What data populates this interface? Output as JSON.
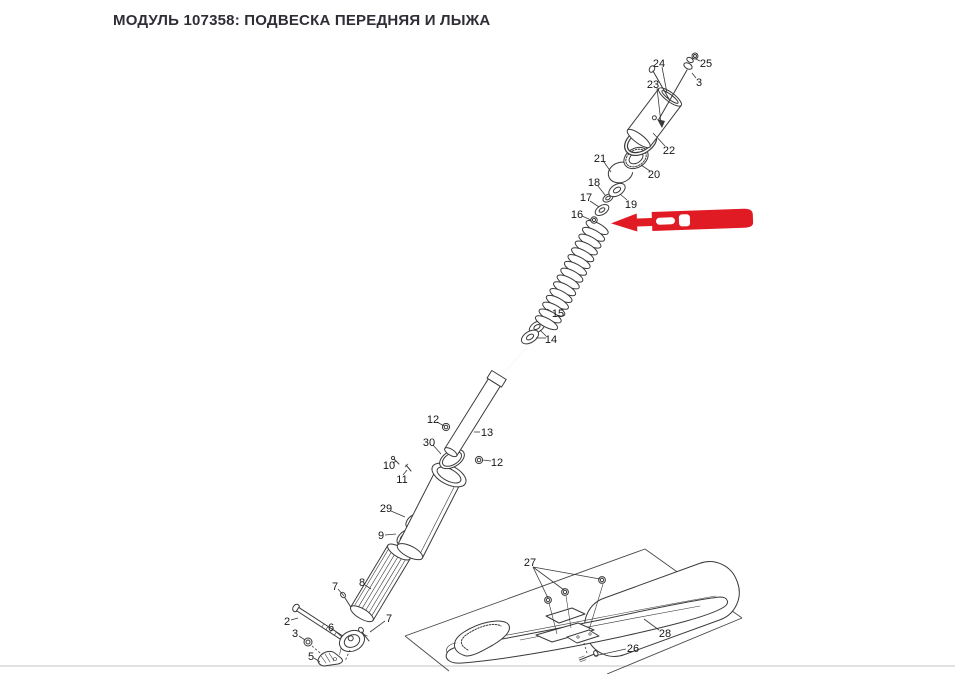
{
  "page": {
    "title": "МОДУЛЬ 107358: ПОДВЕСКА ПЕРЕДНЯЯ И ЛЫЖА"
  },
  "colors": {
    "arrow_red": "#e01b24",
    "line": "#3a3a3a",
    "title_text": "#2e2e36",
    "frame_line": "#cfcfcf"
  },
  "callouts": [
    {
      "label": "24"
    },
    {
      "label": "25"
    },
    {
      "label": "23"
    },
    {
      "label": "3"
    },
    {
      "label": "22"
    },
    {
      "label": "21"
    },
    {
      "label": "20"
    },
    {
      "label": "18"
    },
    {
      "label": "19"
    },
    {
      "label": "17"
    },
    {
      "label": "16"
    },
    {
      "label": "15"
    },
    {
      "label": "14"
    },
    {
      "label": "12"
    },
    {
      "label": "13"
    },
    {
      "label": "30"
    },
    {
      "label": "12"
    },
    {
      "label": "10"
    },
    {
      "label": "11"
    },
    {
      "label": "29"
    },
    {
      "label": "9"
    },
    {
      "label": "8"
    },
    {
      "label": "7"
    },
    {
      "label": "7"
    },
    {
      "label": "6"
    },
    {
      "label": "2"
    },
    {
      "label": "3"
    },
    {
      "label": "5"
    },
    {
      "label": "27"
    },
    {
      "label": "28"
    },
    {
      "label": "26"
    }
  ]
}
